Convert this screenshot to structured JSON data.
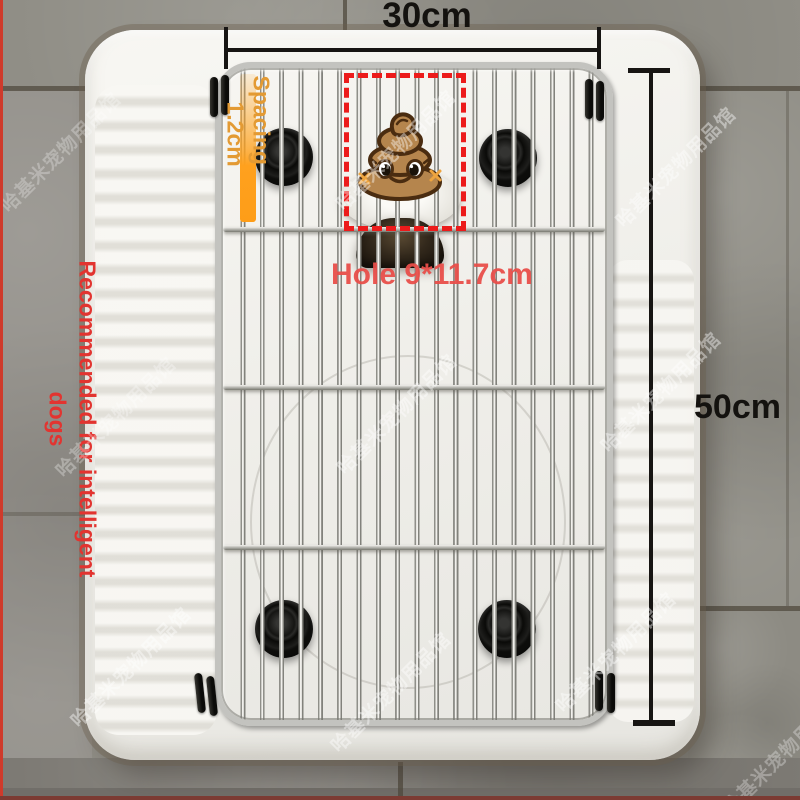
{
  "meta": {
    "type": "product-photo",
    "subject": "Stainless steel pet toilet grate placed over a white squat toilet pan on gray tile floor"
  },
  "annotations": {
    "width": {
      "label": "30cm"
    },
    "height": {
      "label": "50cm"
    },
    "hole": {
      "label": "Hole 9*11.7cm"
    },
    "spacing": {
      "line1": "Spacing",
      "line2": "1.2cm"
    },
    "recommendation": {
      "line1": "Recommended for intelligent",
      "line2": "dogs"
    },
    "sticker": "poop-emoji"
  },
  "watermark": {
    "text": "哈基米宠物用品馆"
  },
  "colors": {
    "dimension_lines": "#171513",
    "hole_text": "#e84e4a",
    "dashed_box": "#ec1b1b",
    "spacing_text": "#e39a33",
    "spacing_strip": "#ffa11e",
    "recommendation_text": "#e23430",
    "watermark": "rgba(255,255,255,0.42)",
    "poop_body": "#b5854d",
    "poop_outline": "#4a2c10",
    "grate_metal": "#c3c3bf",
    "ceramic": "#f3f2ee",
    "tile": "#8f8d83"
  }
}
